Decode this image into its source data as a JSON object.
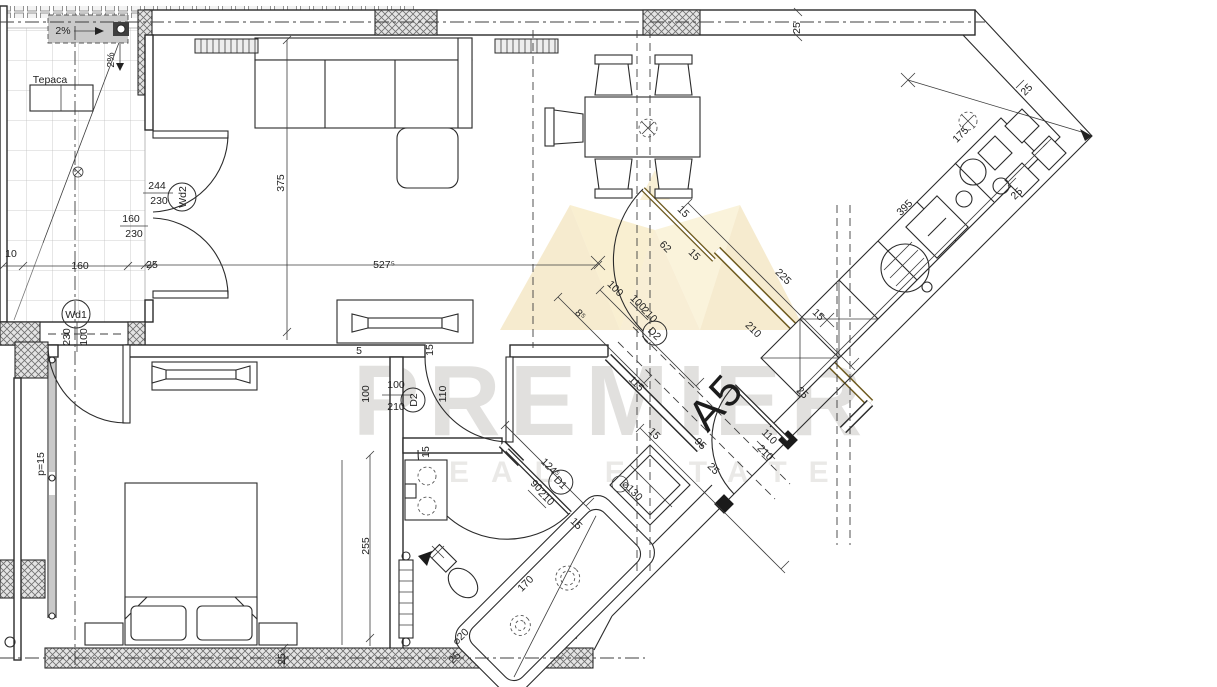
{
  "canvas": {
    "width": 1217,
    "height": 687,
    "background": "#ffffff",
    "line_color": "#2b2b2b"
  },
  "watermark": {
    "brand": "PREMIER",
    "tagline": "REAL ESTATE",
    "gold": "#d9a92c",
    "gray": "#6f6a5f"
  },
  "plan": {
    "apartment_label": "A5",
    "room_label_terrace": "Тераса",
    "annotations": [
      {
        "t": "2%",
        "x": 63,
        "y": 34,
        "r": 0
      },
      {
        "t": "2%",
        "x": 114,
        "y": 60,
        "r": -90
      },
      {
        "t": "Тераса",
        "x": 50,
        "y": 83,
        "r": 0,
        "fs": 13
      },
      {
        "t": "25",
        "x": 800,
        "y": 28,
        "r": -90,
        "fs": 10
      },
      {
        "t": "244",
        "x": 157,
        "y": 189,
        "r": 0
      },
      {
        "t": "230",
        "x": 159,
        "y": 204,
        "r": 0
      },
      {
        "t": "Wd2",
        "x": 186,
        "y": 197,
        "r": -90,
        "enc": 14
      },
      {
        "t": "160",
        "x": 131,
        "y": 222,
        "r": 0
      },
      {
        "t": "230",
        "x": 134,
        "y": 237,
        "r": 0
      },
      {
        "t": "10",
        "x": 11,
        "y": 257,
        "r": 0,
        "fs": 9
      },
      {
        "t": "160",
        "x": 80,
        "y": 269,
        "r": 0
      },
      {
        "t": "25",
        "x": 152,
        "y": 268,
        "r": 0,
        "fs": 9
      },
      {
        "t": "375",
        "x": 284,
        "y": 183,
        "r": -90
      },
      {
        "t": "527⁵",
        "x": 384,
        "y": 268,
        "r": 0
      },
      {
        "t": "Wd1",
        "x": 76,
        "y": 318,
        "r": 0,
        "enc": 14
      },
      {
        "t": "100",
        "x": 87,
        "y": 337,
        "r": -90,
        "fs": 10
      },
      {
        "t": "230",
        "x": 70,
        "y": 337,
        "r": -90,
        "fs": 10
      },
      {
        "t": "p=15",
        "x": 44,
        "y": 464,
        "r": -90
      },
      {
        "t": "15",
        "x": 433,
        "y": 350,
        "r": -90,
        "fs": 9
      },
      {
        "t": "5",
        "x": 359,
        "y": 354,
        "r": 0,
        "fs": 9
      },
      {
        "t": "100",
        "x": 396,
        "y": 388,
        "r": 0
      },
      {
        "t": "210",
        "x": 396,
        "y": 410,
        "r": 0
      },
      {
        "t": "D2",
        "x": 417,
        "y": 400,
        "r": -90,
        "enc": 12
      },
      {
        "t": "100",
        "x": 369,
        "y": 394,
        "r": -90
      },
      {
        "t": "110",
        "x": 446,
        "y": 394,
        "r": -90
      },
      {
        "t": "15",
        "x": 429,
        "y": 452,
        "r": -90,
        "fs": 9
      },
      {
        "t": "255",
        "x": 369,
        "y": 546,
        "r": -90
      },
      {
        "t": "25",
        "x": 285,
        "y": 659,
        "r": -90,
        "fs": 9
      },
      {
        "t": "8⁵",
        "x": 578,
        "y": 317,
        "r": 45,
        "fs": 10
      },
      {
        "t": "100",
        "x": 613,
        "y": 291,
        "r": 45
      },
      {
        "t": "100",
        "x": 636,
        "y": 305,
        "r": 45,
        "fs": 10
      },
      {
        "t": "210",
        "x": 647,
        "y": 317,
        "r": 45,
        "fs": 10
      },
      {
        "t": "D2",
        "x": 652,
        "y": 336,
        "r": 45,
        "enc": 12
      },
      {
        "t": "115",
        "x": 634,
        "y": 386,
        "r": 45
      },
      {
        "t": "15",
        "x": 681,
        "y": 214,
        "r": 45,
        "fs": 9
      },
      {
        "t": "62",
        "x": 663,
        "y": 249,
        "r": 45
      },
      {
        "t": "15",
        "x": 692,
        "y": 257,
        "r": 45,
        "fs": 9
      },
      {
        "t": "225",
        "x": 781,
        "y": 279,
        "r": 45
      },
      {
        "t": "210",
        "x": 751,
        "y": 332,
        "r": 45
      },
      {
        "t": "15",
        "x": 816,
        "y": 317,
        "r": 45,
        "fs": 9
      },
      {
        "t": "25",
        "x": 800,
        "y": 395,
        "r": 45,
        "fs": 9
      },
      {
        "t": "395",
        "x": 907,
        "y": 210,
        "r": -45
      },
      {
        "t": "175",
        "x": 963,
        "y": 137,
        "r": -45
      },
      {
        "t": "25",
        "x": 1029,
        "y": 92,
        "r": -45,
        "fs": 9
      },
      {
        "t": "25",
        "x": 1019,
        "y": 196,
        "r": -45,
        "fs": 9
      },
      {
        "t": "124⁵",
        "x": 548,
        "y": 470,
        "r": 45
      },
      {
        "t": "D1",
        "x": 558,
        "y": 485,
        "r": 45,
        "enc": 12
      },
      {
        "t": "90",
        "x": 534,
        "y": 488,
        "r": 45,
        "fs": 10
      },
      {
        "t": "210",
        "x": 544,
        "y": 500,
        "r": 45,
        "fs": 10
      },
      {
        "t": "15",
        "x": 574,
        "y": 526,
        "r": 45,
        "fs": 9
      },
      {
        "t": "170",
        "x": 528,
        "y": 586,
        "r": -45
      },
      {
        "t": "⌀20",
        "x": 463,
        "y": 639,
        "r": -45,
        "fs": 10
      },
      {
        "t": "25",
        "x": 457,
        "y": 660,
        "r": -45,
        "fs": 9
      },
      {
        "t": "⌀130",
        "x": 630,
        "y": 493,
        "r": 45,
        "fs": 10
      },
      {
        "t": "15",
        "x": 652,
        "y": 436,
        "r": 45,
        "fs": 9
      },
      {
        "t": "95",
        "x": 698,
        "y": 446,
        "r": 45
      },
      {
        "t": "25",
        "x": 711,
        "y": 471,
        "r": 45,
        "fs": 9
      },
      {
        "t": "110",
        "x": 767,
        "y": 439,
        "r": 45
      },
      {
        "t": "210",
        "x": 763,
        "y": 455,
        "r": 45
      }
    ]
  }
}
